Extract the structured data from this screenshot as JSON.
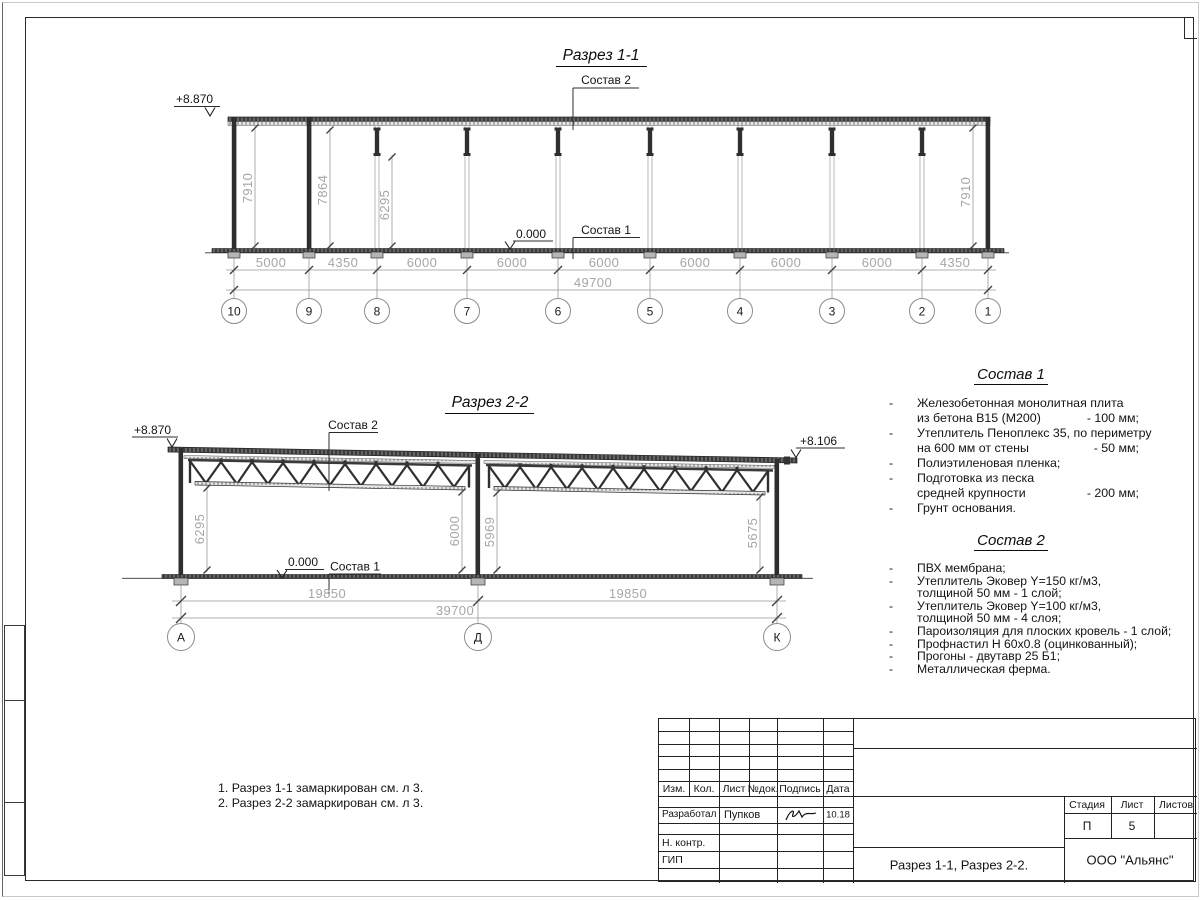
{
  "s1": {
    "title": "Разрез 1-1",
    "elev": "+8.870",
    "zero": "0.000",
    "sostav1_label": "Состав 1",
    "sostav2_label": "Состав 2",
    "h": [
      "7910",
      "7864",
      "6295",
      "7910"
    ],
    "dims": [
      "5000",
      "4350",
      "6000",
      "6000",
      "6000",
      "6000",
      "6000",
      "6000",
      "4350"
    ],
    "total": "49700",
    "grids": [
      "10",
      "9",
      "8",
      "7",
      "6",
      "5",
      "4",
      "3",
      "2",
      "1"
    ]
  },
  "s2": {
    "title": "Разрез 2-2",
    "elev_left": "+8.870",
    "elev_right": "+8.106",
    "zero": "0.000",
    "sostav1_label": "Состав 1",
    "sostav2_label": "Состав 2",
    "h": [
      "6295",
      "6000",
      "5969",
      "5675"
    ],
    "dim_left": "19850",
    "dim_right": "19850",
    "total": "39700",
    "grids": [
      "А",
      "Д",
      "К"
    ]
  },
  "sostav1": {
    "title": "Состав 1",
    "rows": [
      {
        "b": "-",
        "t": "Железобетонная  монолитная плита",
        "v": ""
      },
      {
        "b": "",
        "t": "из бетона В15 (М200)",
        "v": "- 100 мм;"
      },
      {
        "b": "-",
        "t": "Утеплитель Пеноплекс 35, по периметру",
        "v": ""
      },
      {
        "b": "",
        "t": "на 600 мм от стены",
        "v": "- 50 мм;"
      },
      {
        "b": "-",
        "t": "Полиэтиленовая пленка;",
        "v": ""
      },
      {
        "b": "-",
        "t": "Подготовка из песка",
        "v": ""
      },
      {
        "b": "",
        "t": "средней крупности",
        "v": "- 200 мм;"
      },
      {
        "b": "-",
        "t": "Грунт основания.",
        "v": ""
      }
    ]
  },
  "sostav2": {
    "title": "Состав 2",
    "rows": [
      {
        "b": "-",
        "t": "ПВХ мембрана;"
      },
      {
        "b": "-",
        "t": "Утеплитель Эковер Y=150 кг/м3,"
      },
      {
        "b": "",
        "t": "толщиной 50 мм - 1 слой;"
      },
      {
        "b": "-",
        "t": "Утеплитель Эковер Y=100 кг/м3,"
      },
      {
        "b": "",
        "t": "толщиной 50 мм - 4 слоя;"
      },
      {
        "b": "-",
        "t": "Пароизоляция для плоских кровель - 1 слой;"
      },
      {
        "b": "-",
        "t": "Профнастил Н 60х0.8 (оцинкованный);"
      },
      {
        "b": "-",
        "t": "Прогоны - двутавр 25 Б1;"
      },
      {
        "b": "-",
        "t": "Металлическая ферма."
      }
    ]
  },
  "notes": {
    "n1": "1. Разрез 1-1 замаркирован см. л 3.",
    "n2": "2. Разрез 2-2 замаркирован см. л 3."
  },
  "tb": {
    "c1": "Изм.",
    "c2": "Кол.",
    "c3": "Лист",
    "c4": "№док.",
    "c5": "Подпись",
    "c6": "Дата",
    "role1": "Разработал",
    "name1": "Пупков",
    "date1": "10.18",
    "role2": "Н. контр.",
    "role3": "ГИП",
    "stage_h": "Стадия",
    "sheet_h": "Лист",
    "sheets_h": "Листов",
    "stage": "П",
    "sheet_no": "5",
    "title": "Разрез 1-1, Разрез 2-2.",
    "company": "ООО \"Альянс\""
  }
}
